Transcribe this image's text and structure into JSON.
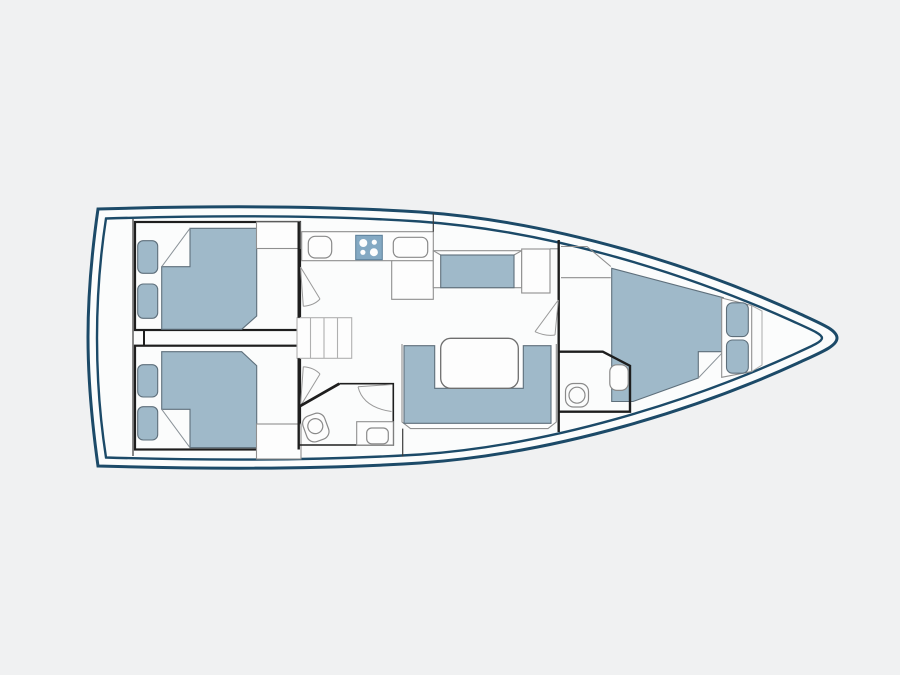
{
  "title": "sailing-yacht-interior-floor-plan",
  "colors": {
    "background": "#f0f1f2",
    "hull_stroke": "#1c4a68",
    "interior_fill": "#fbfcfc",
    "upholstery": "#9fb9c9",
    "stove": "#84a9c3",
    "wall": "#1e1e1e",
    "furniture_outline": "#8f8f8f"
  },
  "features": [
    {
      "name": "hull-outline-icon",
      "count": 1
    },
    {
      "name": "aft-double-berth-icon",
      "count": 2
    },
    {
      "name": "berth-cushion-icon",
      "count": 6
    },
    {
      "name": "wardrobe-locker-icon",
      "count": 2
    },
    {
      "name": "companionway-stairs-icon",
      "count": 1
    },
    {
      "name": "galley-counter-icon",
      "count": 1
    },
    {
      "name": "galley-sink-icon",
      "count": 1
    },
    {
      "name": "stove-four-burner-icon",
      "count": 1
    },
    {
      "name": "salon-bench-settee-icon",
      "count": 1
    },
    {
      "name": "nav-table-icon",
      "count": 1
    },
    {
      "name": "salon-u-settee-icon",
      "count": 1
    },
    {
      "name": "salon-table-icon",
      "count": 1
    },
    {
      "name": "head-toilet-icon",
      "count": 2
    },
    {
      "name": "head-sink-icon",
      "count": 2
    },
    {
      "name": "v-berth-icon",
      "count": 1
    },
    {
      "name": "door-swing-icon",
      "count": 4
    }
  ]
}
